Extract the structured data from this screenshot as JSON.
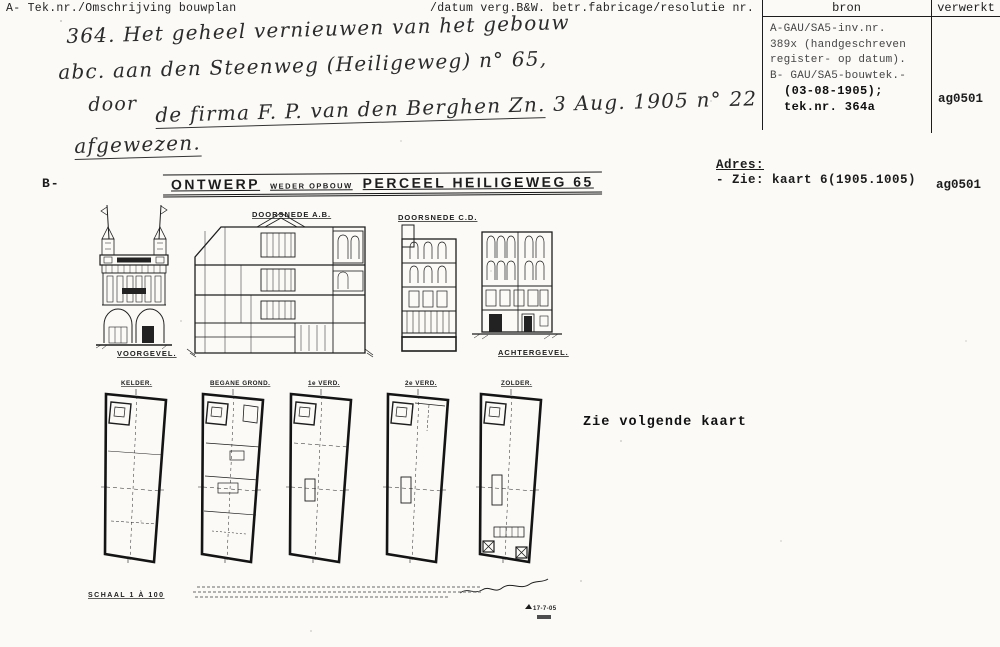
{
  "header": {
    "left": "A- Tek.nr./Omschrijving bouwplan",
    "right": "/datum verg.B&W. betr.fabricage/resolutie nr."
  },
  "bron_table": {
    "col1_header": "bron",
    "col2_header": "verwerkt",
    "lines": [
      {
        "text": "A-GAU/SA5-inv.nr."
      },
      {
        "text": "389x (handgeschreven"
      },
      {
        "text": "register- op datum)."
      },
      {
        "text": "B- GAU/SA5-bouwtek.-"
      },
      {
        "text": "(03-08-1905);"
      },
      {
        "text": "tek.nr. 364a"
      }
    ],
    "verwerkt_value": "ag0501"
  },
  "handwriting": {
    "line1": "364.   Het geheel vernieuwen van het gebouw",
    "line2": "abc. aan den Steenweg (Heiligeweg) n° 65,",
    "line3": "door",
    "line4_underlined": "de firma F. P. van den Berghen Zn.",
    "line4_rest": " 3 Aug. 1905 n° 22",
    "line5": "afgewezen."
  },
  "adres": {
    "label": "Adres:",
    "value": "- Zie: kaart 6(1905.1005)",
    "verwerkt": "ag0501"
  },
  "section_b_label": "B-",
  "drawing": {
    "title_word1": "ONTWERP",
    "title_word2": "WEDER OPBOUW",
    "title_word3": "PERCEEL HEILIGEWEG 65",
    "elevation_labels": [
      "VOORGEVEL.",
      "DOORSNEDE A.B.",
      "DOORSNEDE C.D.",
      "ACHTERGEVEL."
    ],
    "plan_labels": [
      "KELDER.",
      "BEGANE GROND.",
      "1e VERD.",
      "2e VERD.",
      "ZOLDER."
    ],
    "scale_note": "SCHAAL 1 À 100",
    "date_mark": "17-7-05"
  },
  "note_right": "Zie volgende kaart"
}
